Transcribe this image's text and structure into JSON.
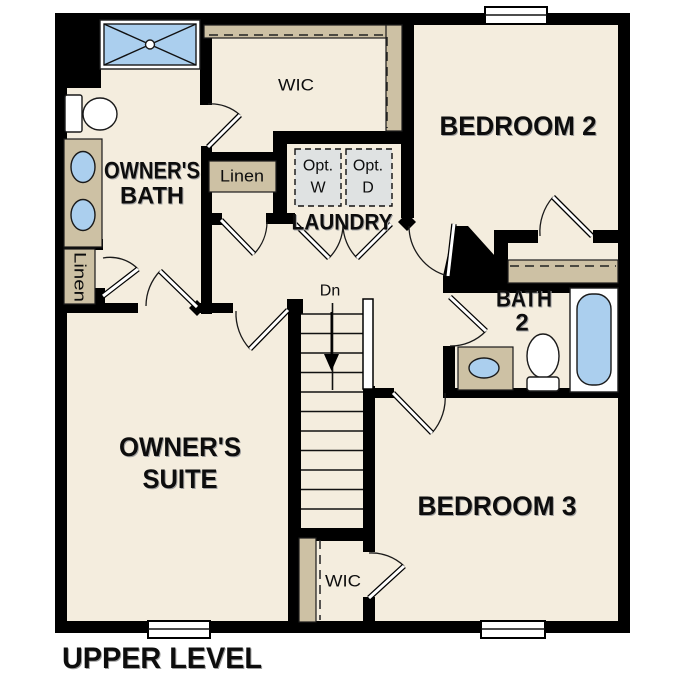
{
  "caption": "UPPER LEVEL",
  "rooms": {
    "owners_bath": {
      "line1": "OWNER'S",
      "line2": "BATH"
    },
    "owners_suite": {
      "line1": "OWNER'S",
      "line2": "SUITE"
    },
    "bedroom2": {
      "label": "BEDROOM 2"
    },
    "bedroom3": {
      "label": "BEDROOM 3"
    },
    "bath2": {
      "line1": "BATH",
      "line2": "2"
    },
    "laundry": {
      "label": "LAUNDRY",
      "opt_washer": {
        "line1": "Opt.",
        "line2": "W"
      },
      "opt_dryer": {
        "line1": "Opt.",
        "line2": "D"
      }
    },
    "wic_top": {
      "label": "WIC"
    },
    "wic_bottom": {
      "label": "WIC"
    },
    "linen_hall": {
      "label": "Linen"
    },
    "linen_owners": {
      "label": "Linen"
    },
    "stairs": {
      "down_label": "Dn"
    }
  },
  "colors": {
    "background": "#ffffff",
    "floor": "#f4edde",
    "wall": "#000000",
    "cabinet_tan": "#cdc1a4",
    "fixture_blue": "#abcfee",
    "appliance_gray": "#dfe2e2"
  }
}
